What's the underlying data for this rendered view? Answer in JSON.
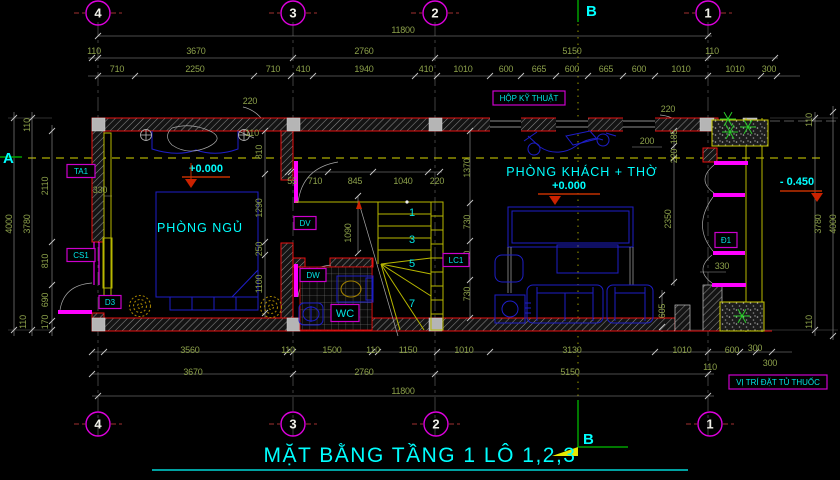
{
  "title": {
    "t": "MẶT BẰNG TẦNG 1 LÔ 1,2,3"
  },
  "colors": {
    "background": "#000000",
    "wall_red": "#E81010",
    "dim_green": "#8CA04A",
    "label_cyan": "#00FFFF",
    "tag_magenta": "#FF00FF",
    "stair_yellow": "#B8B800",
    "furniture_blue": "#1E1EC8",
    "plant_green": "#2ACC2A",
    "elevation_marker_red": "#CC2200"
  },
  "rooms": [
    {
      "name": "PHÒNG NGỦ",
      "x": 200,
      "y": 232
    },
    {
      "name": "PHÒNG KHÁCH + THỜ",
      "x": 582,
      "y": 176
    }
  ],
  "elevations": [
    {
      "t": "+0.000",
      "x": 206,
      "y": 172
    },
    {
      "t": "+0.000",
      "x": 569,
      "y": 189
    },
    {
      "t": "- 0.450",
      "x": 797,
      "y": 185
    }
  ],
  "sections": {
    "a": {
      "t": "A",
      "x": 3,
      "y": 163
    },
    "b_top": {
      "t": "B",
      "x": 586,
      "y": 16
    },
    "b_bottom": {
      "t": "B",
      "x": 583,
      "y": 444
    }
  },
  "grid": {
    "top": [
      {
        "n": "4",
        "x": 98
      },
      {
        "n": "3",
        "x": 293
      },
      {
        "n": "2",
        "x": 435
      },
      {
        "n": "1",
        "x": 708
      }
    ],
    "bottom": [
      {
        "n": "4",
        "x": 98
      },
      {
        "n": "3",
        "x": 293
      },
      {
        "n": "2",
        "x": 436
      },
      {
        "n": "1",
        "x": 710
      }
    ]
  },
  "tags": [
    {
      "t": "TA1",
      "x": 81,
      "y": 171,
      "w": 28,
      "h": 13
    },
    {
      "t": "CS1",
      "x": 81,
      "y": 255,
      "w": 28,
      "h": 13
    },
    {
      "t": "D3",
      "x": 110,
      "y": 302,
      "w": 22,
      "h": 13
    },
    {
      "t": "DV",
      "x": 305,
      "y": 223,
      "w": 22,
      "h": 13
    },
    {
      "t": "DW",
      "x": 313,
      "y": 275,
      "w": 26,
      "h": 13
    },
    {
      "t": "WC",
      "x": 345,
      "y": 313,
      "w": 28,
      "h": 17,
      "big": true
    },
    {
      "t": "LC1",
      "x": 456,
      "y": 260,
      "w": 26,
      "h": 13
    },
    {
      "t": "Đ1",
      "x": 726,
      "y": 240,
      "w": 22,
      "h": 15
    },
    {
      "t": "HỘP KỸ THUẬT",
      "x": 529,
      "y": 98,
      "w": 72,
      "h": 14
    },
    {
      "t": "VỊ TRÍ ĐẶT TỦ THUỐC",
      "x": 778,
      "y": 382,
      "w": 98,
      "h": 14
    }
  ],
  "stairs": {
    "numbers": [
      {
        "t": "1",
        "x": 412,
        "y": 216
      },
      {
        "t": "3",
        "x": 412,
        "y": 243
      },
      {
        "t": "5",
        "x": 412,
        "y": 267
      },
      {
        "t": "7",
        "x": 412,
        "y": 307
      }
    ]
  },
  "dimensions": {
    "labels": [
      {
        "t": "11800",
        "x": 403,
        "y": 33
      },
      {
        "t": "110",
        "x": 94,
        "y": 54
      },
      {
        "t": "3670",
        "x": 196,
        "y": 54
      },
      {
        "t": "2760",
        "x": 364,
        "y": 54
      },
      {
        "t": "5150",
        "x": 572,
        "y": 54
      },
      {
        "t": "110",
        "x": 712,
        "y": 54
      },
      {
        "t": "710",
        "x": 117,
        "y": 72
      },
      {
        "t": "2250",
        "x": 195,
        "y": 72
      },
      {
        "t": "710",
        "x": 273,
        "y": 72
      },
      {
        "t": "410",
        "x": 303,
        "y": 72
      },
      {
        "t": "1940",
        "x": 364,
        "y": 72
      },
      {
        "t": "410",
        "x": 426,
        "y": 72
      },
      {
        "t": "1010",
        "x": 463,
        "y": 72
      },
      {
        "t": "600",
        "x": 506,
        "y": 72
      },
      {
        "t": "665",
        "x": 539,
        "y": 72
      },
      {
        "t": "600",
        "x": 572,
        "y": 72
      },
      {
        "t": "665",
        "x": 606,
        "y": 72
      },
      {
        "t": "600",
        "x": 639,
        "y": 72
      },
      {
        "t": "1010",
        "x": 681,
        "y": 72
      },
      {
        "t": "1010",
        "x": 735,
        "y": 72
      },
      {
        "t": "300",
        "x": 769,
        "y": 72
      },
      {
        "t": "220",
        "x": 250,
        "y": 104
      },
      {
        "t": "110",
        "x": 252,
        "y": 136
      },
      {
        "t": "220",
        "x": 668,
        "y": 112
      },
      {
        "t": "200",
        "x": 647,
        "y": 144
      },
      {
        "t": "185",
        "x": 677,
        "y": 137,
        "r": 1
      },
      {
        "t": "220",
        "x": 677,
        "y": 156,
        "r": 1
      },
      {
        "t": "4000",
        "x": 12,
        "y": 224,
        "r": 1
      },
      {
        "t": "3780",
        "x": 30,
        "y": 224,
        "r": 1
      },
      {
        "t": "110",
        "x": 30,
        "y": 125,
        "r": 1
      },
      {
        "t": "2110",
        "x": 48,
        "y": 186,
        "r": 1
      },
      {
        "t": "810",
        "x": 48,
        "y": 261,
        "r": 1
      },
      {
        "t": "690",
        "x": 48,
        "y": 300,
        "r": 1
      },
      {
        "t": "170",
        "x": 48,
        "y": 322,
        "r": 1
      },
      {
        "t": "110",
        "x": 26,
        "y": 322,
        "r": 1
      },
      {
        "t": "810",
        "x": 262,
        "y": 152,
        "r": 1
      },
      {
        "t": "1290",
        "x": 262,
        "y": 208,
        "r": 1
      },
      {
        "t": "250",
        "x": 262,
        "y": 249,
        "r": 1
      },
      {
        "t": "1100",
        "x": 262,
        "y": 284,
        "r": 1
      },
      {
        "t": "330",
        "x": 100,
        "y": 193
      },
      {
        "t": "55",
        "x": 292,
        "y": 184
      },
      {
        "t": "710",
        "x": 315,
        "y": 184
      },
      {
        "t": "845",
        "x": 355,
        "y": 184
      },
      {
        "t": "1040",
        "x": 403,
        "y": 184
      },
      {
        "t": "220",
        "x": 437,
        "y": 184
      },
      {
        "t": "1090",
        "x": 351,
        "y": 233,
        "r": 1
      },
      {
        "t": "1370",
        "x": 470,
        "y": 168,
        "r": 1
      },
      {
        "t": "730",
        "x": 470,
        "y": 222,
        "r": 1
      },
      {
        "t": "730",
        "x": 470,
        "y": 258,
        "r": 1
      },
      {
        "t": "730",
        "x": 470,
        "y": 294,
        "r": 1
      },
      {
        "t": "2350",
        "x": 671,
        "y": 219,
        "r": 1
      },
      {
        "t": "605",
        "x": 665,
        "y": 311,
        "r": 1
      },
      {
        "t": "330",
        "x": 722,
        "y": 269
      },
      {
        "t": "110",
        "x": 812,
        "y": 120,
        "r": 1
      },
      {
        "t": "3780",
        "x": 821,
        "y": 224,
        "r": 1
      },
      {
        "t": "4000",
        "x": 836,
        "y": 224,
        "r": 1
      },
      {
        "t": "110",
        "x": 812,
        "y": 322,
        "r": 1
      },
      {
        "t": "3560",
        "x": 190,
        "y": 353
      },
      {
        "t": "110",
        "x": 288,
        "y": 353
      },
      {
        "t": "1500",
        "x": 332,
        "y": 353
      },
      {
        "t": "110",
        "x": 373,
        "y": 353
      },
      {
        "t": "1150",
        "x": 408,
        "y": 353
      },
      {
        "t": "1010",
        "x": 464,
        "y": 353
      },
      {
        "t": "3130",
        "x": 572,
        "y": 353
      },
      {
        "t": "1010",
        "x": 682,
        "y": 353
      },
      {
        "t": "600",
        "x": 732,
        "y": 353
      },
      {
        "t": "300",
        "x": 755,
        "y": 351
      },
      {
        "t": "300",
        "x": 770,
        "y": 366
      },
      {
        "t": "110",
        "x": 710,
        "y": 370
      },
      {
        "t": "3670",
        "x": 193,
        "y": 375
      },
      {
        "t": "2760",
        "x": 364,
        "y": 375
      },
      {
        "t": "5150",
        "x": 570,
        "y": 375
      },
      {
        "t": "11800",
        "x": 403,
        "y": 394
      }
    ]
  }
}
